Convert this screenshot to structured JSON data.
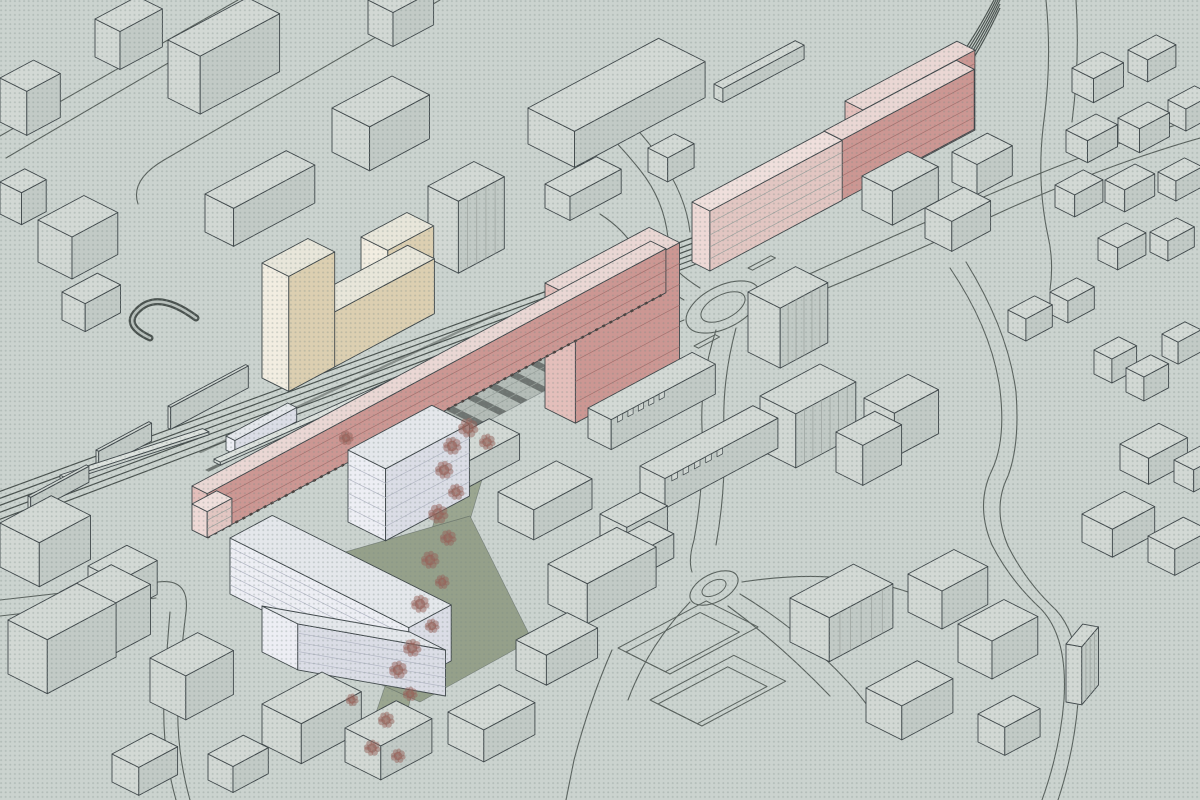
{
  "canvas": {
    "w": 1200,
    "h": 800
  },
  "palette": {
    "background": "#cbd3cf",
    "dot": "#768782",
    "line": "#3f474a",
    "context_side": "#c2cac6",
    "context_end": "#d2d8d4",
    "context_top": "#d3d9d5",
    "context_detail": "#9aa19d",
    "pink_side": "#cc9793",
    "pink_end": "#e4bfbb",
    "pink_top": "#ead7d4",
    "pink_line": "#a3716e",
    "pinkpale_side": "#e2c6c2",
    "pinkpale_end": "#eed9d6",
    "pinkpale_top": "#efdfdc",
    "beige_side": "#dccfb1",
    "beige_end": "#f2ede1",
    "beige_top": "#e8e6da",
    "beige_line": "#b9ac8e",
    "lav_side": "#dbdde6",
    "lav_end": "#edeef4",
    "lav_top": "#e4e7eb",
    "lav_line": "#b4b8c5",
    "green": "#9ba690",
    "green_dark": "#95a08a",
    "plaza": "#b4bcb7",
    "plaza_band": "#6e7471",
    "plaza_grid": "#99a19c",
    "track": "#4a524f",
    "band_light": "#8a918d",
    "platform_side": "#c9d0cc",
    "platform_end": "#d6dcd8",
    "platform_top": "#dde2de",
    "road": "#5a625e",
    "ramp_dark": "#4a524f",
    "ramp_light": "#b9c1bd",
    "tree": "#956259",
    "arcade": "#4b4340"
  },
  "projection": {
    "au_deg": -28.1,
    "av_deg": 26.6
  },
  "ground": {
    "green_areas": [
      {
        "id": "linear-park",
        "pts": [
          [
            455,
            430
          ],
          [
            492,
            446
          ],
          [
            470,
            520
          ],
          [
            440,
            600
          ],
          [
            415,
            680
          ],
          [
            400,
            742
          ],
          [
            368,
            736
          ],
          [
            394,
            660
          ],
          [
            418,
            580
          ],
          [
            440,
            500
          ]
        ],
        "fill": "green"
      },
      {
        "id": "courtyard-green",
        "pts": [
          [
            300,
            565
          ],
          [
            470,
            516
          ],
          [
            532,
            640
          ],
          [
            420,
            702
          ],
          [
            330,
            662
          ]
        ],
        "fill": "green_dark"
      }
    ],
    "plaza": {
      "origin": [
        340,
        452
      ],
      "u": 300,
      "d": 52,
      "band_step": 24,
      "band_w": 8,
      "grid_v": [
        13,
        26,
        39
      ]
    },
    "nw_bands": [
      {
        "origin": [
          205,
          470
        ],
        "u": 325,
        "d": 4,
        "au": -26,
        "fill": "plaza_band"
      },
      {
        "origin": [
          215,
          487
        ],
        "u": 318,
        "d": 4,
        "au": -27.5,
        "fill": "plaza_band"
      },
      {
        "origin": [
          198,
          452
        ],
        "u": 332,
        "d": 3,
        "au": -25,
        "fill": "band_light"
      }
    ]
  },
  "rail": {
    "n_tracks": 6,
    "spacing": 7
  },
  "roads": {
    "singles": [
      "M 238 0 L 0 136",
      "M 262 8 L 6 158",
      "M 440 0 L 164 160 Q 130 180 138 204",
      "M 560 96 Q 600 120 640 170 Q 664 200 668 238",
      "M 586 84 Q 625 110 660 158 Q 686 196 690 232",
      "M 684 300 Q 650 280 640 258 Q 628 232 600 214",
      "M 700 288 Q 668 268 660 246",
      "M 684 320 Q 630 342 586 368",
      "M 762 296 Q 860 250 1000 190 Q 1110 143 1200 118",
      "M 768 312 Q 880 268 1010 208 Q 1115 162 1200 138",
      "M 716 330 Q 700 380 702 428 Q 704 488 694 540 Q 688 560 692 572",
      "M 736 328 Q 722 380 724 430 Q 726 490 716 545",
      "M 740 594 Q 800 630 848 682 Q 870 706 880 726",
      "M 728 606 Q 780 644 830 696",
      "M 690 602 Q 648 646 628 700",
      "M 742 582 Q 820 570 880 584 Q 930 596 952 614",
      "M 950 268 Q 992 330 1000 390 Q 1006 440 992 470 Q 975 505 992 545 Q 1010 580 1040 608 Q 1068 636 1064 700 Q 1060 750 1042 800",
      "M 966 262 Q 1008 330 1016 392 Q 1020 444 1008 476 Q 992 508 1008 546 Q 1026 582 1056 610 Q 1082 638 1078 702 Q 1074 752 1058 800",
      "M 1046 0 Q 1052 60 1044 120 Q 1036 180 1048 236 Q 1054 262 1050 290",
      "M 1076 0 Q 1080 60 1072 122",
      "M 0 600 Q 120 586 158 582 Q 190 578 186 612 Q 180 660 178 700 Q 176 750 190 800",
      "M 0 616 Q 120 602 156 598",
      "M 170 612 Q 166 660 164 700 Q 162 750 176 800",
      "M 612 650 Q 590 700 574 760 L 566 800"
    ],
    "roundabouts": [
      {
        "cx": 723,
        "cy": 307,
        "rx": 40,
        "ry": 21,
        "irx": 24,
        "iry": 12,
        "rot": -27
      },
      {
        "cx": 714,
        "cy": 588,
        "rx": 26,
        "ry": 14,
        "irx": 13,
        "iry": 7,
        "rot": -27
      }
    ],
    "islands": [
      {
        "origin": [
          748,
          268
        ],
        "u": 26,
        "d": 5
      },
      {
        "origin": [
          694,
          346
        ],
        "u": 24,
        "d": 5
      },
      {
        "origin": [
          804,
          296
        ],
        "u": 22,
        "d": 5
      }
    ],
    "fields": [
      {
        "origin": [
          618,
          648
        ],
        "u": 100,
        "d": 58
      },
      {
        "origin": [
          626,
          652
        ],
        "u": 84,
        "d": 44
      },
      {
        "origin": [
          650,
          700
        ],
        "u": 95,
        "d": 58
      },
      {
        "origin": [
          658,
          704
        ],
        "u": 79,
        "d": 44
      }
    ],
    "ramp": "M 196 318 Q 158 290 138 310 Q 122 325 150 338"
  },
  "buildings": [
    {
      "id": "context-block",
      "x": 168,
      "y": 98,
      "w": 90,
      "d": 36,
      "h": 58
    },
    {
      "id": "context-block",
      "x": 95,
      "y": 57,
      "w": 48,
      "d": 28,
      "h": 38
    },
    {
      "id": "context-block",
      "x": 368,
      "y": 34,
      "w": 46,
      "d": 28,
      "h": 34
    },
    {
      "id": "context-block",
      "x": 332,
      "y": 152,
      "w": 68,
      "d": 42,
      "h": 44
    },
    {
      "id": "context-block",
      "x": 205,
      "y": 232,
      "w": 92,
      "d": 32,
      "h": 38
    },
    {
      "id": "context-block",
      "x": 38,
      "y": 262,
      "w": 52,
      "d": 38,
      "h": 42
    },
    {
      "id": "context-block",
      "x": 0,
      "y": 122,
      "w": 38,
      "d": 30,
      "h": 44
    },
    {
      "id": "context-block",
      "x": 62,
      "y": 320,
      "w": 40,
      "d": 26,
      "h": 28
    },
    {
      "id": "context-tower",
      "x": 428,
      "y": 258,
      "w": 52,
      "d": 34,
      "h": 72,
      "vstripes": 4
    },
    {
      "id": "context-block",
      "x": 0,
      "y": 214,
      "w": 28,
      "d": 24,
      "h": 32
    },
    {
      "id": "warehouse",
      "x": 528,
      "y": 144,
      "w": 148,
      "d": 52,
      "h": 36
    },
    {
      "id": "context-block",
      "x": 545,
      "y": 208,
      "w": 58,
      "d": 28,
      "h": 24
    },
    {
      "id": "context-bar",
      "x": 714,
      "y": 98,
      "w": 92,
      "d": 10,
      "h": 14
    },
    {
      "id": "context-block",
      "x": 648,
      "y": 172,
      "w": 30,
      "d": 22,
      "h": 24
    },
    {
      "id": "cottage",
      "x": 1072,
      "y": 92,
      "w": 34,
      "d": 24,
      "h": 24
    },
    {
      "id": "cottage",
      "x": 1128,
      "y": 72,
      "w": 32,
      "d": 22,
      "h": 22
    },
    {
      "id": "cottage",
      "x": 1066,
      "y": 152,
      "w": 34,
      "d": 24,
      "h": 22
    },
    {
      "id": "cottage",
      "x": 1118,
      "y": 142,
      "w": 34,
      "d": 24,
      "h": 24
    },
    {
      "id": "cottage",
      "x": 1168,
      "y": 122,
      "w": 30,
      "d": 20,
      "h": 22
    },
    {
      "id": "cottage",
      "x": 1055,
      "y": 207,
      "w": 32,
      "d": 22,
      "h": 22
    },
    {
      "id": "cottage",
      "x": 1105,
      "y": 202,
      "w": 34,
      "d": 22,
      "h": 22
    },
    {
      "id": "cottage",
      "x": 1158,
      "y": 192,
      "w": 30,
      "d": 20,
      "h": 20
    },
    {
      "id": "cottage",
      "x": 1098,
      "y": 260,
      "w": 32,
      "d": 22,
      "h": 22
    },
    {
      "id": "cottage",
      "x": 1150,
      "y": 252,
      "w": 30,
      "d": 20,
      "h": 20
    },
    {
      "id": "context-block",
      "x": 862,
      "y": 210,
      "w": 52,
      "d": 34,
      "h": 34
    },
    {
      "id": "context-block",
      "x": 925,
      "y": 238,
      "w": 44,
      "d": 30,
      "h": 30
    },
    {
      "id": "context-block",
      "x": 952,
      "y": 182,
      "w": 40,
      "d": 28,
      "h": 30
    },
    {
      "id": "context-block",
      "x": 1008,
      "y": 332,
      "w": 30,
      "d": 20,
      "h": 22
    },
    {
      "id": "context-block",
      "x": 1050,
      "y": 314,
      "w": 30,
      "d": 20,
      "h": 22
    },
    {
      "id": "context-block",
      "x": 1094,
      "y": 374,
      "w": 28,
      "d": 20,
      "h": 24
    },
    {
      "id": "context-block",
      "x": 1126,
      "y": 392,
      "w": 28,
      "d": 20,
      "h": 24
    },
    {
      "id": "context-block",
      "x": 1162,
      "y": 356,
      "w": 26,
      "d": 18,
      "h": 22
    },
    {
      "id": "context-tower",
      "x": 748,
      "y": 352,
      "w": 54,
      "d": 36,
      "h": 60,
      "vstripes": 5
    },
    {
      "id": "context-tower",
      "x": 760,
      "y": 450,
      "w": 68,
      "d": 40,
      "h": 54,
      "vstripes": 6
    },
    {
      "id": "context-block",
      "x": 836,
      "y": 472,
      "w": 44,
      "d": 30,
      "h": 40
    },
    {
      "id": "context-block",
      "x": 864,
      "y": 442,
      "w": 50,
      "d": 34,
      "h": 44
    },
    {
      "id": "rowhouses",
      "x": 588,
      "y": 438,
      "w": 118,
      "d": 26,
      "h": 30,
      "teeth": true
    },
    {
      "id": "rowhouses",
      "x": 640,
      "y": 496,
      "w": 128,
      "d": 28,
      "h": 30,
      "teeth": true
    },
    {
      "id": "context-block",
      "x": 438,
      "y": 472,
      "w": 58,
      "d": 34,
      "h": 26
    },
    {
      "id": "context-block",
      "x": 498,
      "y": 522,
      "w": 66,
      "d": 40,
      "h": 30
    },
    {
      "id": "context-block",
      "x": 600,
      "y": 540,
      "w": 46,
      "d": 30,
      "h": 26
    },
    {
      "id": "context-block",
      "x": 548,
      "y": 604,
      "w": 78,
      "d": 44,
      "h": 40
    },
    {
      "id": "context-block",
      "x": 516,
      "y": 670,
      "w": 58,
      "d": 34,
      "h": 30
    },
    {
      "id": "context-block",
      "x": 610,
      "y": 566,
      "w": 44,
      "d": 28,
      "h": 24
    },
    {
      "id": "context-block",
      "x": 262,
      "y": 744,
      "w": 68,
      "d": 44,
      "h": 40
    },
    {
      "id": "context-block",
      "x": 345,
      "y": 762,
      "w": 58,
      "d": 40,
      "h": 34
    },
    {
      "id": "context-block",
      "x": 448,
      "y": 744,
      "w": 58,
      "d": 40,
      "h": 32
    },
    {
      "id": "context-block",
      "x": 150,
      "y": 702,
      "w": 54,
      "d": 40,
      "h": 44
    },
    {
      "id": "context-block",
      "x": 60,
      "y": 642,
      "w": 58,
      "d": 44,
      "h": 50
    },
    {
      "id": "context-block",
      "x": 8,
      "y": 674,
      "w": 78,
      "d": 44,
      "h": 54
    },
    {
      "id": "context-block",
      "x": 112,
      "y": 782,
      "w": 44,
      "d": 30,
      "h": 28
    },
    {
      "id": "context-block",
      "x": 208,
      "y": 780,
      "w": 40,
      "d": 28,
      "h": 26
    },
    {
      "id": "context-block",
      "x": 0,
      "y": 567,
      "w": 58,
      "d": 44,
      "h": 44
    },
    {
      "id": "context-block",
      "x": 88,
      "y": 600,
      "w": 44,
      "d": 34,
      "h": 34
    },
    {
      "id": "rail-wall",
      "x": 168,
      "y": 428,
      "w": 88,
      "d": 3,
      "h": 22
    },
    {
      "id": "rail-wall",
      "x": 96,
      "y": 468,
      "w": 60,
      "d": 3,
      "h": 18
    },
    {
      "id": "rail-wall",
      "x": 28,
      "y": 512,
      "w": 66,
      "d": 3,
      "h": 16
    },
    {
      "id": "context-tower",
      "x": 790,
      "y": 642,
      "w": 72,
      "d": 44,
      "h": 44,
      "vstripes": 5
    },
    {
      "id": "context-block",
      "x": 908,
      "y": 612,
      "w": 52,
      "d": 38,
      "h": 38
    },
    {
      "id": "context-block",
      "x": 958,
      "y": 662,
      "w": 52,
      "d": 38,
      "h": 38
    },
    {
      "id": "context-block",
      "x": 866,
      "y": 722,
      "w": 58,
      "d": 40,
      "h": 34
    },
    {
      "id": "context-tower",
      "x": 1066,
      "y": 702,
      "w": 26,
      "d": 16,
      "h": 58,
      "au": -50,
      "av": 10,
      "vstripes": 3
    },
    {
      "id": "context-block",
      "x": 978,
      "y": 742,
      "w": 40,
      "d": 30,
      "h": 28
    },
    {
      "id": "context-block",
      "x": 1082,
      "y": 542,
      "w": 48,
      "d": 34,
      "h": 28
    },
    {
      "id": "context-block",
      "x": 1148,
      "y": 562,
      "w": 40,
      "d": 30,
      "h": 26
    },
    {
      "id": "context-block",
      "x": 1174,
      "y": 482,
      "w": 30,
      "d": 22,
      "h": 22
    },
    {
      "id": "context-block",
      "x": 1120,
      "y": 470,
      "w": 44,
      "d": 32,
      "h": 26
    },
    {
      "id": "station-platform",
      "x": 214,
      "y": 462,
      "w": 330,
      "d": 7,
      "h": 3,
      "pal": "platform",
      "au": -24
    },
    {
      "id": "station-platform",
      "x": 60,
      "y": 478,
      "w": 150,
      "d": 7,
      "h": 3,
      "pal": "platform",
      "au": -18
    },
    {
      "id": "platform-building",
      "x": 226,
      "y": 450,
      "w": 70,
      "d": 10,
      "h": 14,
      "pal": "lav"
    },
    {
      "id": "proposed-pink-slab-upper-step",
      "x": 845,
      "y": 181,
      "w": 127,
      "d": 20,
      "h": 80,
      "pal": "pink",
      "floors": 6
    },
    {
      "id": "proposed-pink-slab-upper-east",
      "x": 824,
      "y": 191,
      "w": 150,
      "d": 20,
      "h": 60,
      "pal": "pink",
      "floors": 5
    },
    {
      "id": "proposed-pink-slab-upper-west",
      "x": 692,
      "y": 262,
      "w": 150,
      "d": 20,
      "h": 60,
      "pal": "pinkpale",
      "floors": 5
    },
    {
      "id": "proposed-pink-tower",
      "x": 545,
      "y": 408,
      "w": 118,
      "d": 34,
      "h": 125,
      "pal": "pink",
      "floors": 6
    },
    {
      "id": "proposed-pink-slab-central",
      "x": 192,
      "y": 530,
      "w": 520,
      "d": 17,
      "h": 44,
      "pal": "pink",
      "floors": 4,
      "baseDash": true
    },
    {
      "id": "proposed-pink-slab-central-tip",
      "x": 192,
      "y": 530,
      "w": 28,
      "d": 17,
      "h": 26,
      "pal": "pinkpale",
      "floors": 3
    },
    {
      "id": "beige-u-building-bar",
      "x": 262,
      "y": 378,
      "w": 165,
      "d": 30,
      "h": 55,
      "pal": "beige"
    },
    {
      "id": "beige-u-building-tower-left",
      "x": 262,
      "y": 378,
      "w": 52,
      "d": 30,
      "h": 115,
      "pal": "beige"
    },
    {
      "id": "beige-u-building-tower-right",
      "x": 361,
      "y": 325,
      "w": 52,
      "d": 30,
      "h": 88,
      "pal": "beige"
    },
    {
      "id": "lavender-block-tower",
      "x": 348,
      "y": 522,
      "w": 95,
      "d": 42,
      "h": 72,
      "pal": "lav",
      "floors": 5,
      "endFloors": 5
    },
    {
      "id": "lavender-court-west-wing",
      "x": 230,
      "y": 594,
      "w": 48,
      "d": 200,
      "h": 56,
      "pal": "lav",
      "endFloors": 6
    },
    {
      "id": "lavender-court-south-wing",
      "x": 262,
      "y": 652,
      "w": 150,
      "d": 40,
      "h": 46,
      "pal": "lav",
      "floors": 5,
      "au": 10,
      "sort": 760
    }
  ],
  "trees": [
    [
      468,
      428,
      11
    ],
    [
      487,
      442,
      9
    ],
    [
      452,
      446,
      10
    ],
    [
      444,
      470,
      10
    ],
    [
      456,
      492,
      9
    ],
    [
      438,
      514,
      11
    ],
    [
      448,
      538,
      9
    ],
    [
      430,
      560,
      10
    ],
    [
      442,
      582,
      8
    ],
    [
      420,
      604,
      10
    ],
    [
      432,
      626,
      8
    ],
    [
      412,
      648,
      10
    ],
    [
      398,
      670,
      10
    ],
    [
      410,
      694,
      8
    ],
    [
      386,
      720,
      9
    ],
    [
      372,
      748,
      9
    ],
    [
      352,
      700,
      7
    ],
    [
      398,
      756,
      8
    ],
    [
      346,
      438,
      8
    ]
  ]
}
